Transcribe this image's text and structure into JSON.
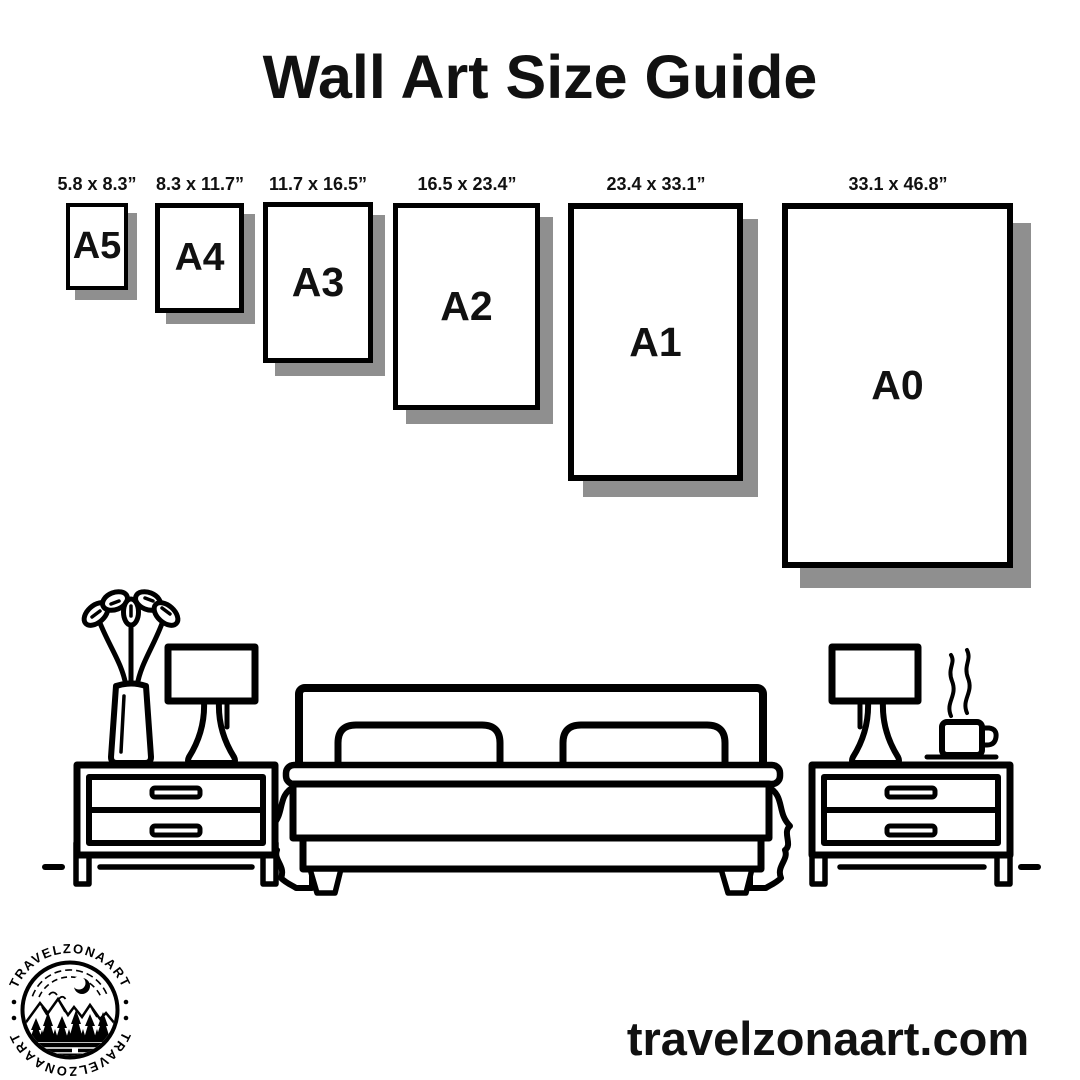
{
  "title": "Wall Art Size Guide",
  "size_guide": {
    "items": [
      {
        "name": "A5",
        "dimensions": "5.8 x 8.3”"
      },
      {
        "name": "A4",
        "dimensions": "8.3 x 11.7”"
      },
      {
        "name": "A3",
        "dimensions": "11.7 x 16.5”"
      },
      {
        "name": "A2",
        "dimensions": "16.5 x 23.4”"
      },
      {
        "name": "A1",
        "dimensions": "23.4 x 33.1”"
      },
      {
        "name": "A0",
        "dimensions": "33.1 x 46.8”"
      }
    ]
  },
  "illustration": {
    "description": "line-art bedroom scene",
    "icons": {
      "bed": "bed-icon",
      "left_nightstand": "nightstand-icon",
      "right_nightstand": "nightstand-icon",
      "left_lamp": "table-lamp-icon",
      "right_lamp": "table-lamp-icon",
      "plant": "plant-vase-icon",
      "coffee": "coffee-cup-icon"
    }
  },
  "logo": {
    "brand": "TRAVELZONAART",
    "separator": "•",
    "scene": "mountains-moon-forest-lake"
  },
  "footer": {
    "website": "travelzonaart.com"
  },
  "colors": {
    "ink": "#000000",
    "shadow": "#8f8f8f",
    "background": "#ffffff"
  }
}
